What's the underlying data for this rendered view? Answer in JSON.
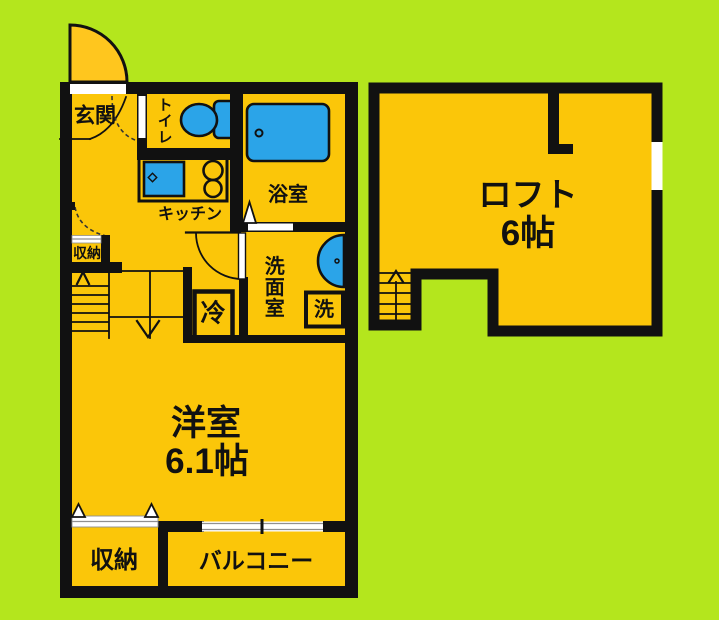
{
  "colors": {
    "background": "#B4E61D",
    "room_fill": "#FBC609",
    "entrance_door_fill": "#FFC61E",
    "fixture_blue": "#2BA4E8",
    "wall": "#111111",
    "label_text": "#111111"
  },
  "labels": {
    "genkan": "玄関",
    "toilet": "トイレ",
    "kitchen": "キッチン",
    "bathroom": "浴室",
    "washroom": "洗面室",
    "washer": "洗",
    "fridge": "冷",
    "hall_closet": "収納",
    "main_room_name": "洋室",
    "main_room_size": "6.1帖",
    "closet": "収納",
    "balcony": "バルコニー",
    "loft_name": "ロフト",
    "loft_size": "6帖"
  }
}
